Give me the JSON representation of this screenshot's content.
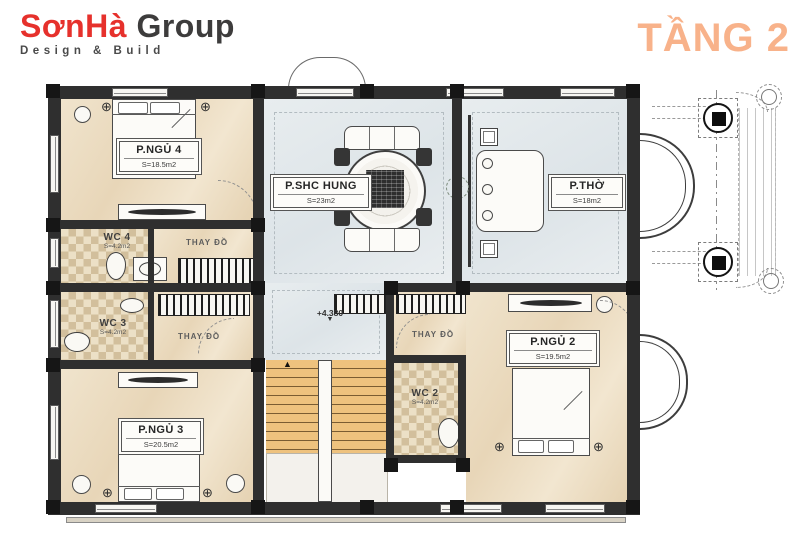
{
  "header": {
    "logo": {
      "brand": "SơnHà",
      "brand_suffix": "Group",
      "tagline": "Design & Build"
    },
    "title": "TẦNG 2"
  },
  "colors": {
    "accent_title": "#F8B28A",
    "logo_red": "#E6312C",
    "logo_dark": "#3D3C3C",
    "wall": "#2F2F2F",
    "floor_beige": "#EADAC0",
    "floor_blue": "#E2E8EB",
    "floor_tile": "#D6C4A2",
    "stair_wood": "#EEC27E"
  },
  "rooms": {
    "pngu4": {
      "name": "P.NGỦ 4",
      "area": "S=18.5m2"
    },
    "pngu3": {
      "name": "P.NGỦ 3",
      "area": "S=20.5m2"
    },
    "pngu2": {
      "name": "P.NGỦ 2",
      "area": "S=19.5m2"
    },
    "pshc": {
      "name": "P.SHC HUNG",
      "area": "S=23m2"
    },
    "ptho": {
      "name": "P.THỜ",
      "area": "S=18m2"
    },
    "wc4": {
      "name": "WC 4",
      "area": "S=4.2m2"
    },
    "wc3": {
      "name": "WC 3",
      "area": "S=4.2m2"
    },
    "wc2": {
      "name": "WC 2",
      "area": "S=4.2m2"
    },
    "closet": {
      "label": "THAY ĐỒ"
    }
  },
  "annotations": {
    "level_marker": "+4.380"
  },
  "icons": {
    "fan": "⊕",
    "plant": "✳",
    "level_triangle": "▼",
    "stair_arrow": "▲"
  }
}
